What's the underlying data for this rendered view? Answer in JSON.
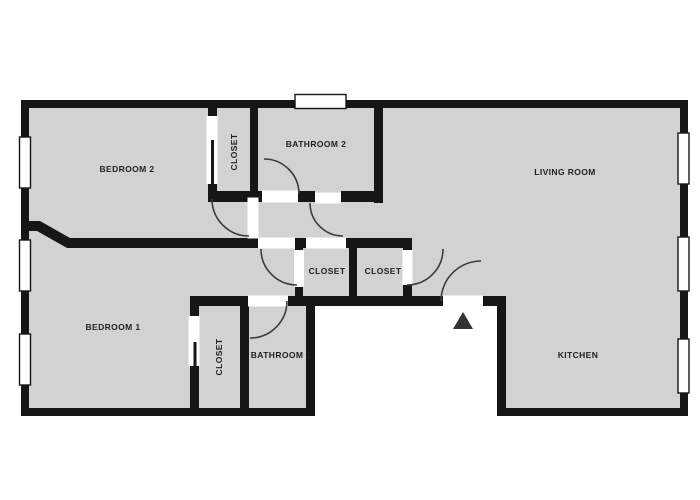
{
  "title": "apartment floor plan",
  "rooms": {
    "bedroom2": {
      "label": "BEDROOM 2"
    },
    "closet_top": {
      "label": "CLOSET"
    },
    "bathroom2": {
      "label": "BATHROOM 2"
    },
    "living_room": {
      "label": "LIVING ROOM"
    },
    "closet_mid_left": {
      "label": "CLOSET"
    },
    "closet_mid_right": {
      "label": "CLOSET"
    },
    "bedroom1": {
      "label": "BEDROOM 1"
    },
    "closet_bottom": {
      "label": "CLOSET"
    },
    "bathroom1": {
      "label": "BATHROOM 1"
    },
    "kitchen": {
      "label": "KITCHEN"
    }
  },
  "icons": {
    "entry_marker": "entry-arrow"
  },
  "colors": {
    "wall": "#161616",
    "floor": "#d2d2d2",
    "background": "#ffffff",
    "door_arc": "#3c3c3c",
    "opening": "#ffffff",
    "label_text": "#1f1f1f",
    "entry_arrow": "#333333"
  }
}
